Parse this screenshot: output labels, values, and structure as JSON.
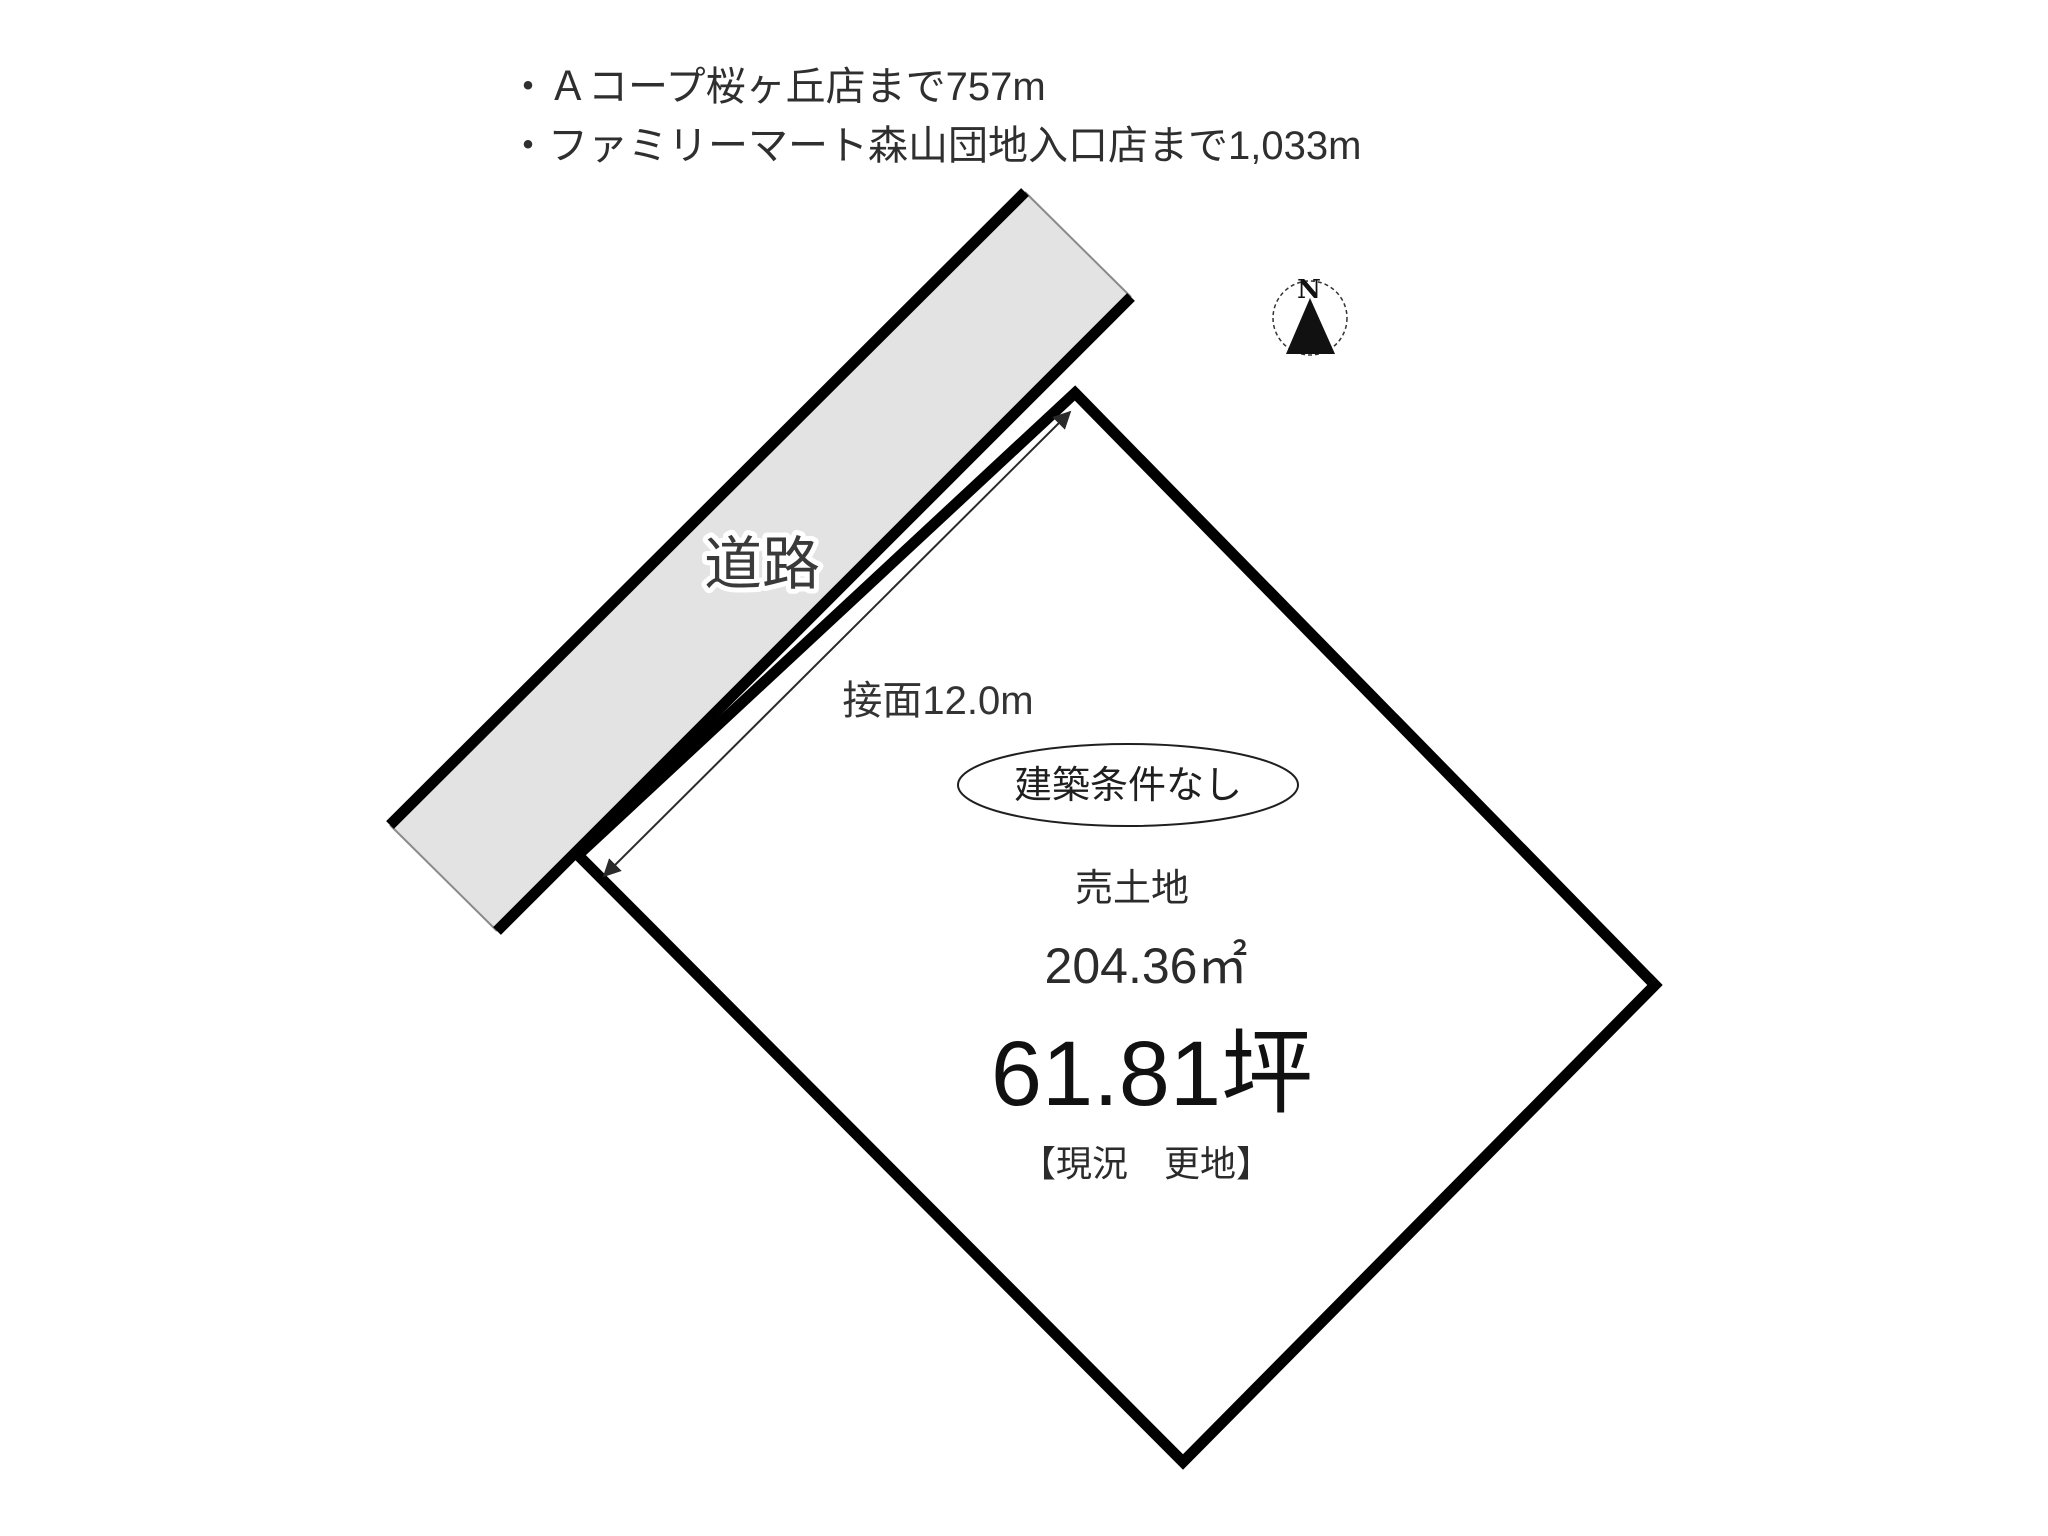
{
  "landmarks": {
    "items": [
      {
        "label": "・Ａコープ桜ヶ丘店まで757m"
      },
      {
        "label": "・ファミリーマート森山団地入口店まで1,033m"
      }
    ]
  },
  "compass": {
    "letter": "N"
  },
  "road": {
    "label": "道路",
    "fill": "#e3e3e3"
  },
  "frontage": {
    "label": "接面12.0m"
  },
  "parcel": {
    "badge": "建築条件なし",
    "type": "売土地",
    "area_m2": "204.36㎡",
    "area_tsubo": "61.81坪",
    "status": "【現況　更地】"
  },
  "colors": {
    "outline": "#000000",
    "text": "#2d2d2d",
    "road_fill": "#e3e3e3"
  }
}
